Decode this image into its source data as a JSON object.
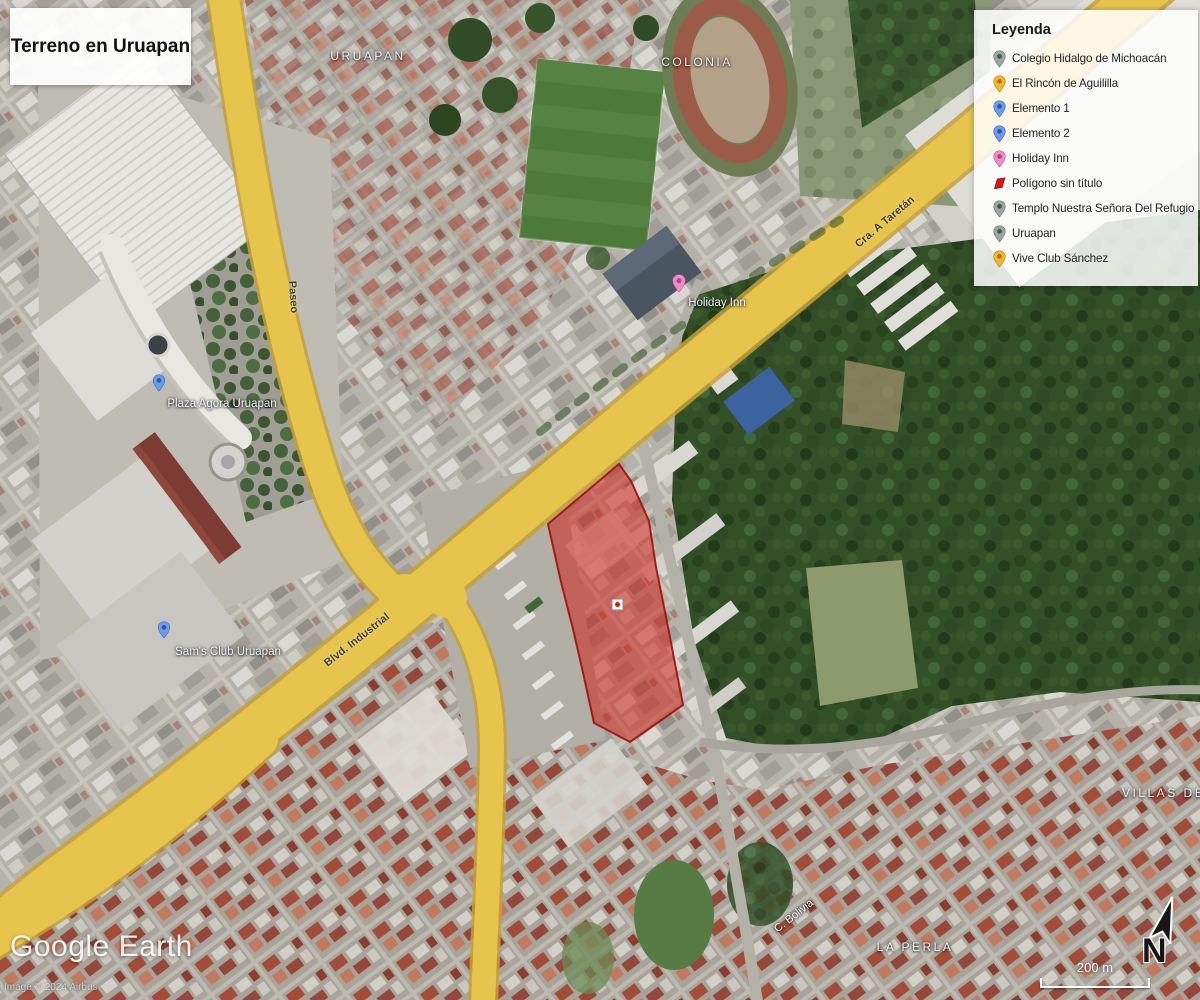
{
  "title": "Terreno en Uruapan",
  "legend": {
    "title": "Leyenda",
    "items": [
      {
        "label": "Colegio Hidalgo de Michoacán",
        "icon": "pin",
        "color": "#98a69f"
      },
      {
        "label": "El Rincón de Aguililla",
        "icon": "pin",
        "color": "#f2b52e"
      },
      {
        "label": "Elemento 1",
        "icon": "pin",
        "color": "#6d9bea"
      },
      {
        "label": "Elemento 2",
        "icon": "pin",
        "color": "#6d9bea"
      },
      {
        "label": "Holiday Inn",
        "icon": "pin",
        "color": "#ef8cc5"
      },
      {
        "label": "Polígono sin título",
        "icon": "polygon",
        "color": "#e0170d"
      },
      {
        "label": "Templo Nuestra Señora Del Refugio",
        "icon": "pin",
        "color": "#98a69f"
      },
      {
        "label": "Uruapan",
        "icon": "pin",
        "color": "#98a69f"
      },
      {
        "label": "Vive Club Sánchez",
        "icon": "pin",
        "color": "#f2b52e"
      }
    ]
  },
  "map_labels": {
    "uruapan": "URUAPAN",
    "colonia": "COLONIA",
    "la_perla": "LA PERLA",
    "villas": "VILLAS DE",
    "holiday_inn": "Holiday Inn",
    "plaza_agora": "Plaza Agora Uruapan",
    "sams_club": "Sam's Club Uruapan",
    "blvd_industrial": "Blvd. Industrial",
    "cra_taretan": "Cra. A Taretán",
    "paseo": "Paseo",
    "c_bolivia": "C. Bolivia"
  },
  "overlay": {
    "watermark": "Google Earth",
    "attribution": "Image © 2024 Airbus",
    "scale_label": "200 m",
    "north_label": "N"
  },
  "colors": {
    "polygon_fill": "#cf1d13",
    "road_yellow": "#e7c44b",
    "forest_green": "#324f28"
  }
}
